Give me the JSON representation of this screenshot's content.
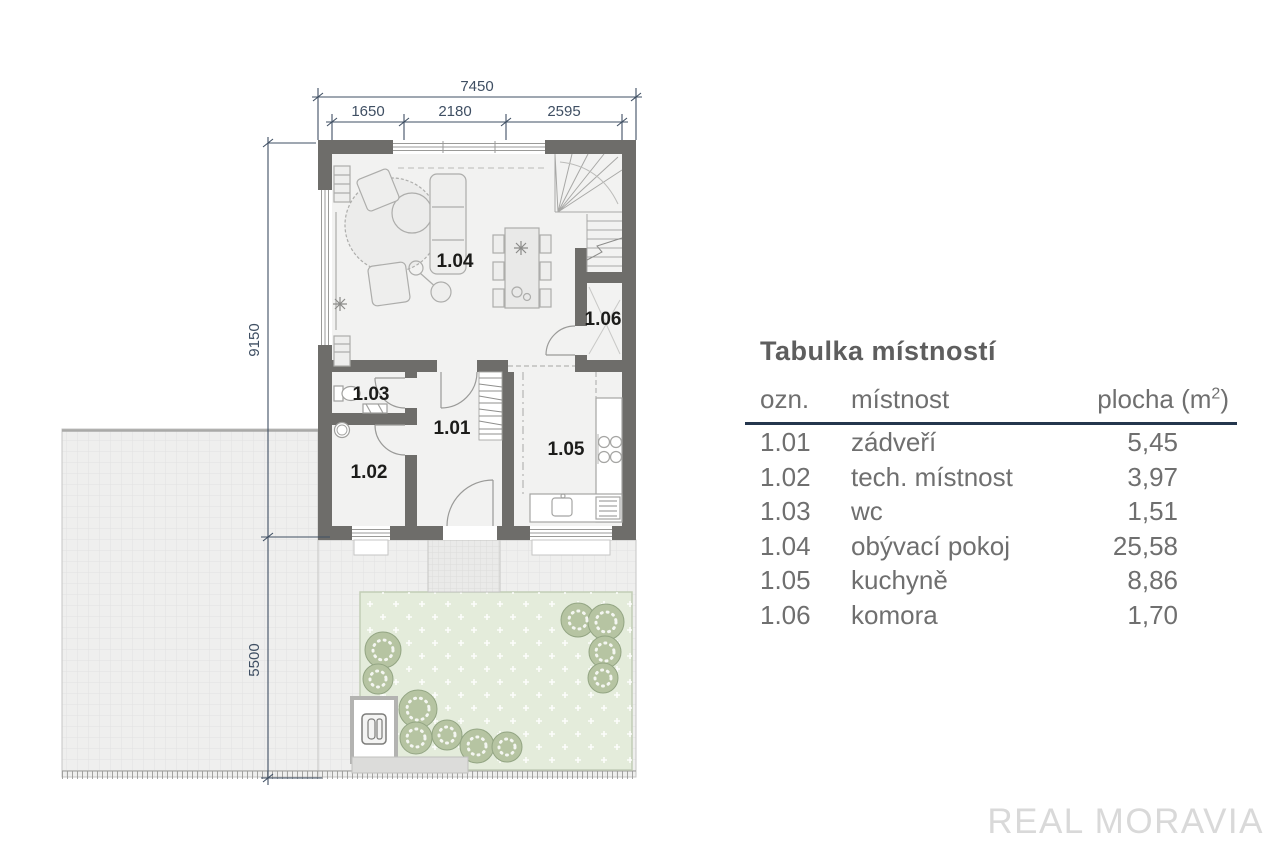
{
  "floor_plan": {
    "dimensions": {
      "width_total": "7450",
      "width_segments": [
        "1650",
        "2180",
        "2595"
      ],
      "height_main": "9150",
      "height_terrace": "5500"
    },
    "room_labels": {
      "r1_01": "1.01",
      "r1_02": "1.02",
      "r1_03": "1.03",
      "r1_04": "1.04",
      "r1_05": "1.05",
      "r1_06": "1.06"
    }
  },
  "room_table": {
    "title": "Tabulka místností",
    "columns": {
      "id": "ozn.",
      "name": "místnost",
      "area_prefix": "plocha (m",
      "area_sup": "2",
      "area_suffix": ")"
    },
    "rows": [
      {
        "id": "1.01",
        "name": "zádveří",
        "area": "5,45"
      },
      {
        "id": "1.02",
        "name": "tech. místnost",
        "area": "3,97"
      },
      {
        "id": "1.03",
        "name": "wc",
        "area": "1,51"
      },
      {
        "id": "1.04",
        "name": "obývací pokoj",
        "area": "25,58"
      },
      {
        "id": "1.05",
        "name": "kuchyně",
        "area": "8,86"
      },
      {
        "id": "1.06",
        "name": "komora",
        "area": "1,70"
      }
    ]
  },
  "watermark": {
    "label": "REAL MORAVIA"
  },
  "colors": {
    "wall": "#6e6d6a",
    "floor": "#f2f2f1",
    "dimension": "#3f4f63",
    "garden": "#e4ecdb",
    "table_rule": "#24364d",
    "table_text": "#6f6f6f",
    "watermark": "#d9d9d9"
  }
}
